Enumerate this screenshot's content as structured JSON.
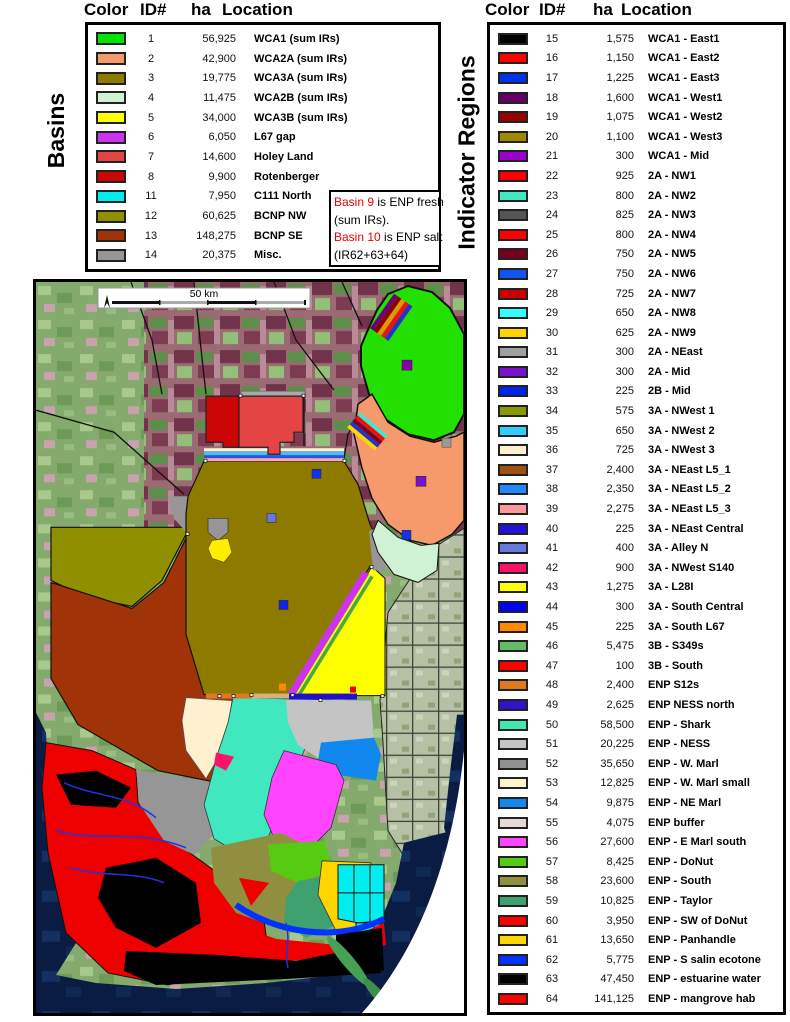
{
  "basins": {
    "label": "Basins",
    "headers": [
      "Color",
      "ID#",
      "ha",
      "Location"
    ],
    "rows": [
      {
        "id": "1",
        "ha": "56,925",
        "location": "WCA1 (sum IRs)",
        "color": "#00e400"
      },
      {
        "id": "2",
        "ha": "42,900",
        "location": "WCA2A (sum IRs)",
        "color": "#f79a6b"
      },
      {
        "id": "3",
        "ha": "19,775",
        "location": "WCA3A (sum IRs)",
        "color": "#8f7a00"
      },
      {
        "id": "4",
        "ha": "11,475",
        "location": "WCA2B (sum IRs)",
        "color": "#cff2d4"
      },
      {
        "id": "5",
        "ha": "34,000",
        "location": "WCA3B (sum IRs)",
        "color": "#ffff00"
      },
      {
        "id": "6",
        "ha": "6,050",
        "location": "L67 gap",
        "color": "#cc33ee"
      },
      {
        "id": "7",
        "ha": "14,600",
        "location": "Holey Land",
        "color": "#e54444"
      },
      {
        "id": "8",
        "ha": "9,900",
        "location": "Rotenberger",
        "color": "#cc0505"
      },
      {
        "id": "11",
        "ha": "7,950",
        "location": "C111 North",
        "color": "#00eeee"
      },
      {
        "id": "12",
        "ha": "60,625",
        "location": "BCNP NW",
        "color": "#8f8f00"
      },
      {
        "id": "13",
        "ha": "148,275",
        "location": "BCNP SE",
        "color": "#a03308"
      },
      {
        "id": "14",
        "ha": "20,375",
        "location": "Misc.",
        "color": "#969696"
      }
    ],
    "note_lines": [
      [
        {
          "t": "Basin 9",
          "red": true
        },
        {
          "t": " is ENP fresh",
          "red": false
        }
      ],
      [
        {
          "t": "(sum IRs).",
          "red": false
        }
      ],
      [
        {
          "t": "Basin 10",
          "red": true
        },
        {
          "t": " is ENP salt",
          "red": false
        }
      ],
      [
        {
          "t": "(IR62+63+64)",
          "red": false
        }
      ]
    ]
  },
  "indicator_regions": {
    "label": "Indicator Regions",
    "headers": [
      "Color",
      "ID#",
      "ha",
      "Location"
    ],
    "rows": [
      {
        "id": "15",
        "ha": "1,575",
        "location": "WCA1 - East1",
        "color": "#000000"
      },
      {
        "id": "16",
        "ha": "1,150",
        "location": "WCA1 - East2",
        "color": "#ff0000"
      },
      {
        "id": "17",
        "ha": "1,225",
        "location": "WCA1 - East3",
        "color": "#0033ee"
      },
      {
        "id": "18",
        "ha": "1,600",
        "location": "WCA1 - West1",
        "color": "#660066"
      },
      {
        "id": "19",
        "ha": "1,075",
        "location": "WCA1 - West2",
        "color": "#990000"
      },
      {
        "id": "20",
        "ha": "1,100",
        "location": "WCA1 - West3",
        "color": "#a08800"
      },
      {
        "id": "21",
        "ha": "300",
        "location": "WCA1 - Mid",
        "color": "#9900cc"
      },
      {
        "id": "22",
        "ha": "925",
        "location": "2A - NW1",
        "color": "#ff0000"
      },
      {
        "id": "23",
        "ha": "800",
        "location": "2A - NW2",
        "color": "#3fe8c0"
      },
      {
        "id": "24",
        "ha": "825",
        "location": "2A - NW3",
        "color": "#555555"
      },
      {
        "id": "25",
        "ha": "800",
        "location": "2A - NW4",
        "color": "#ff0000"
      },
      {
        "id": "26",
        "ha": "750",
        "location": "2A - NW5",
        "color": "#770022"
      },
      {
        "id": "27",
        "ha": "750",
        "location": "2A - NW6",
        "color": "#1155ee"
      },
      {
        "id": "28",
        "ha": "725",
        "location": "2A - NW7",
        "color": "#cc0000"
      },
      {
        "id": "29",
        "ha": "650",
        "location": "2A - NW8",
        "color": "#33ffff"
      },
      {
        "id": "30",
        "ha": "625",
        "location": "2A - NW9",
        "color": "#ffd500"
      },
      {
        "id": "31",
        "ha": "300",
        "location": "2A - NEast",
        "color": "#a0a0a0"
      },
      {
        "id": "32",
        "ha": "300",
        "location": "2A - Mid",
        "color": "#7711cc"
      },
      {
        "id": "33",
        "ha": "225",
        "location": "2B - Mid",
        "color": "#0022ee"
      },
      {
        "id": "34",
        "ha": "575",
        "location": "3A - NWest 1",
        "color": "#8b9900"
      },
      {
        "id": "35",
        "ha": "650",
        "location": "3A - NWest 2",
        "color": "#33ccff"
      },
      {
        "id": "36",
        "ha": "725",
        "location": "3A - NWest 3",
        "color": "#fff0d0"
      },
      {
        "id": "37",
        "ha": "2,400",
        "location": "3A - NEast L5_1",
        "color": "#a05010"
      },
      {
        "id": "38",
        "ha": "2,350",
        "location": "3A - NEast L5_2",
        "color": "#2288ff"
      },
      {
        "id": "39",
        "ha": "2,275",
        "location": "3A - NEast L5_3",
        "color": "#ff9999"
      },
      {
        "id": "40",
        "ha": "225",
        "location": "3A - NEast Central",
        "color": "#2211dd"
      },
      {
        "id": "41",
        "ha": "400",
        "location": "3A - Alley N",
        "color": "#6677dd"
      },
      {
        "id": "42",
        "ha": "900",
        "location": "3A - NWest S140",
        "color": "#ff1166"
      },
      {
        "id": "43",
        "ha": "1,275",
        "location": "3A - L28I",
        "color": "#ffff00"
      },
      {
        "id": "44",
        "ha": "300",
        "location": "3A - South Central",
        "color": "#0000ff"
      },
      {
        "id": "45",
        "ha": "225",
        "location": "3A - South L67",
        "color": "#ff8800"
      },
      {
        "id": "46",
        "ha": "5,475",
        "location": "3B - S349s",
        "color": "#66bb66"
      },
      {
        "id": "47",
        "ha": "100",
        "location": "3B - South",
        "color": "#ff0000"
      },
      {
        "id": "48",
        "ha": "2,400",
        "location": "ENP S12s",
        "color": "#e07820"
      },
      {
        "id": "49",
        "ha": "2,625",
        "location": "ENP NESS north",
        "color": "#3311cc"
      },
      {
        "id": "50",
        "ha": "58,500",
        "location": "ENP - Shark",
        "color": "#3fe8b0"
      },
      {
        "id": "51",
        "ha": "20,225",
        "location": "ENP - NESS",
        "color": "#c4c4c4"
      },
      {
        "id": "52",
        "ha": "35,650",
        "location": "ENP - W. Marl",
        "color": "#909090"
      },
      {
        "id": "53",
        "ha": "12,825",
        "location": "ENP - W. Marl small",
        "color": "#fff5cc"
      },
      {
        "id": "54",
        "ha": "9,875",
        "location": "ENP - NE Marl",
        "color": "#1188ee"
      },
      {
        "id": "55",
        "ha": "4,075",
        "location": "ENP  buffer",
        "color": "#e7dad5"
      },
      {
        "id": "56",
        "ha": "27,600",
        "location": "ENP - E Marl south",
        "color": "#ff44ff"
      },
      {
        "id": "57",
        "ha": "8,425",
        "location": "ENP - DoNut",
        "color": "#55cc11"
      },
      {
        "id": "58",
        "ha": "23,600",
        "location": "ENP - South",
        "color": "#8f8f3f"
      },
      {
        "id": "59",
        "ha": "10,825",
        "location": "ENP - Taylor",
        "color": "#3fa070"
      },
      {
        "id": "60",
        "ha": "3,950",
        "location": "ENP - SW of DoNut",
        "color": "#ff0000"
      },
      {
        "id": "61",
        "ha": "13,650",
        "location": "ENP - Panhandle",
        "color": "#ffd700"
      },
      {
        "id": "62",
        "ha": "5,775",
        "location": "ENP - S salin ecotone",
        "color": "#0033ff"
      },
      {
        "id": "63",
        "ha": "47,450",
        "location": "ENP - estuarine water",
        "color": "#000000"
      },
      {
        "id": "64",
        "ha": "141,125",
        "location": "ENP - mangrove hab",
        "color": "#ff0000"
      }
    ]
  },
  "map": {
    "scale_label": "50 km",
    "note_red_color": "#ee0000"
  }
}
